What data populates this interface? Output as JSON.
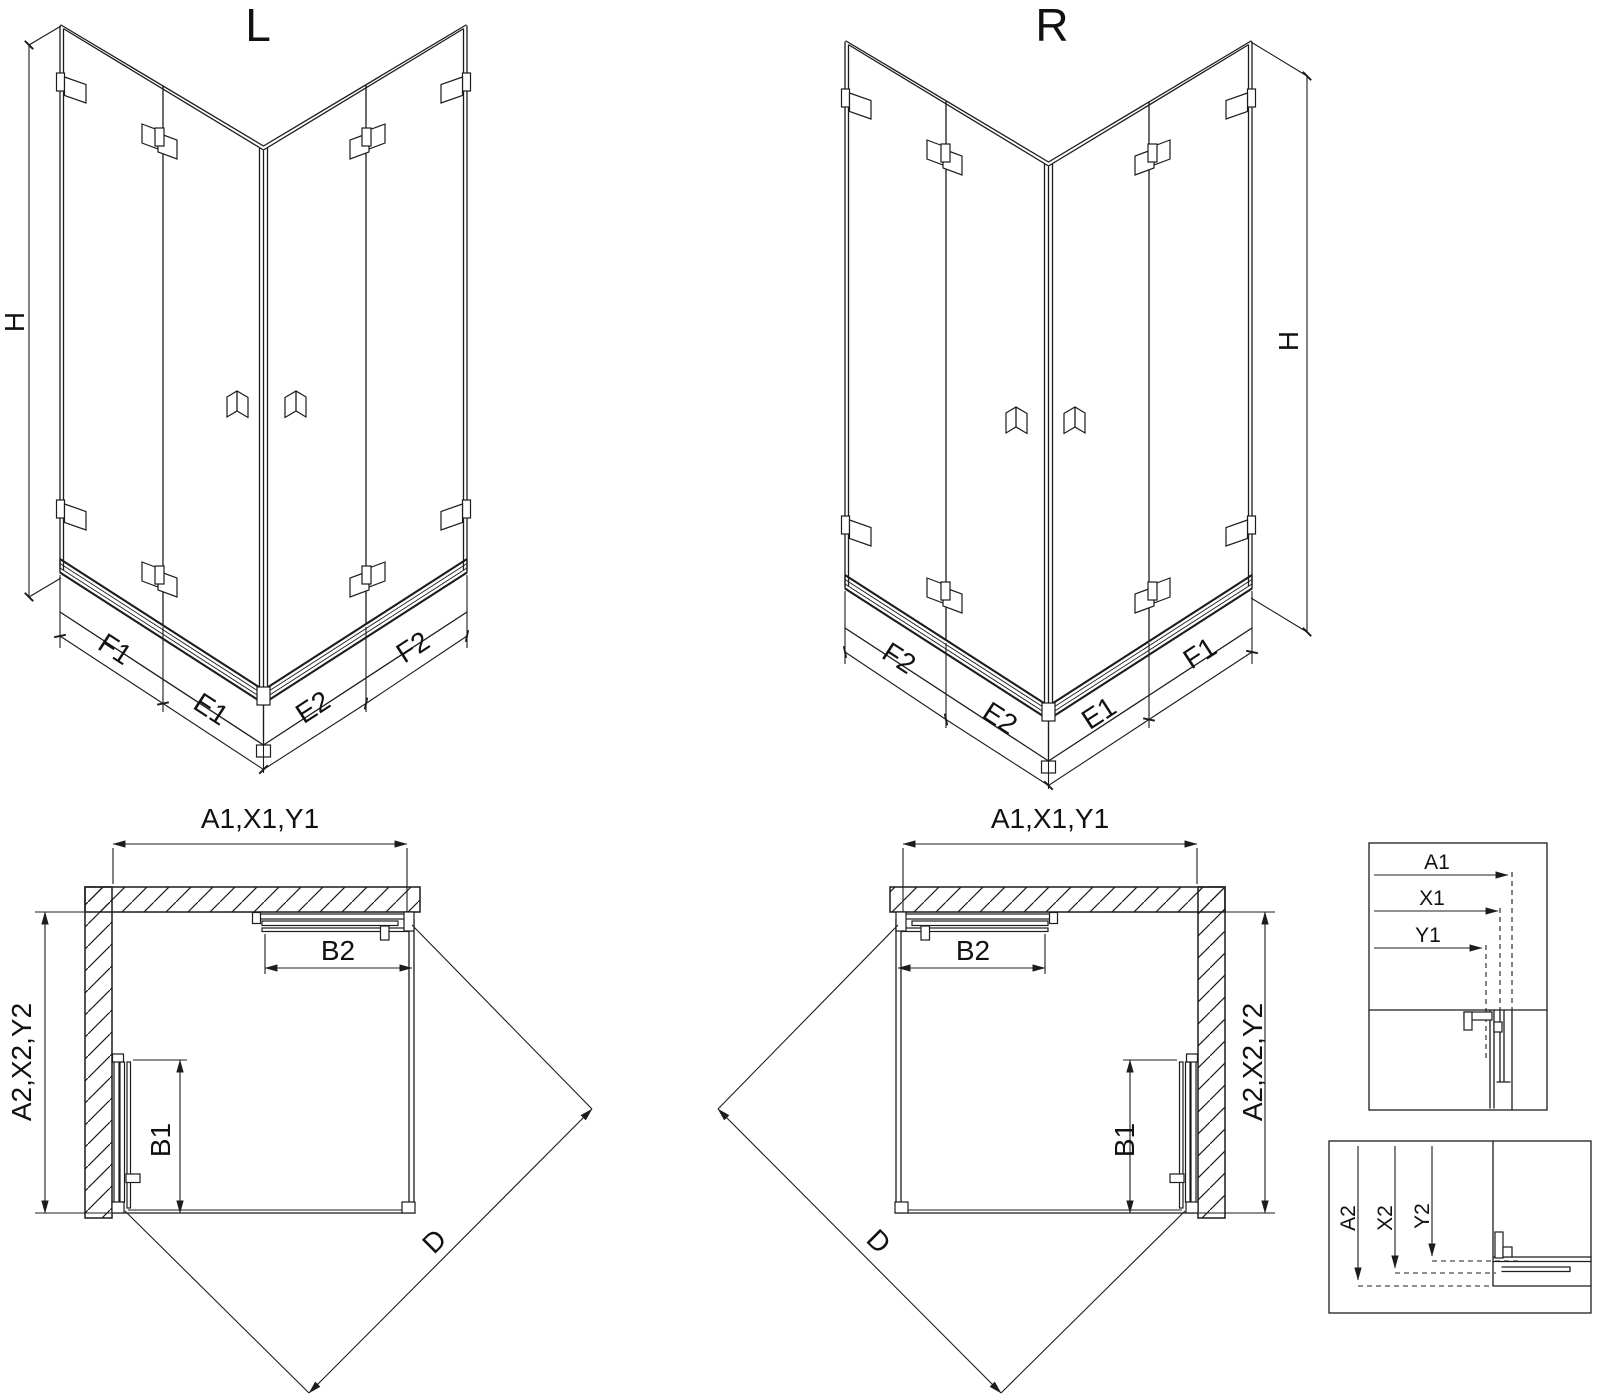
{
  "iso_left": {
    "title": "L",
    "h": "H",
    "f1": "F1",
    "e1": "E1",
    "e2": "E2",
    "f2": "F2"
  },
  "iso_right": {
    "title": "R",
    "h": "H",
    "f2": "F2",
    "e2": "E2",
    "e1": "E1",
    "f1": "F1"
  },
  "plan_left": {
    "width": "A1,X1,Y1",
    "depth": "A2,X2,Y2",
    "b1": "B1",
    "b2": "B2",
    "d": "D"
  },
  "plan_mid": {
    "width": "A1,X1,Y1",
    "depth": "A2,X2,Y2",
    "b1": "B1",
    "b2": "B2",
    "d": "D"
  },
  "detail_top": {
    "a1": "A1",
    "x1": "X1",
    "y1": "Y1"
  },
  "detail_bottom": {
    "a2": "A2",
    "x2": "X2",
    "y2": "Y2"
  }
}
